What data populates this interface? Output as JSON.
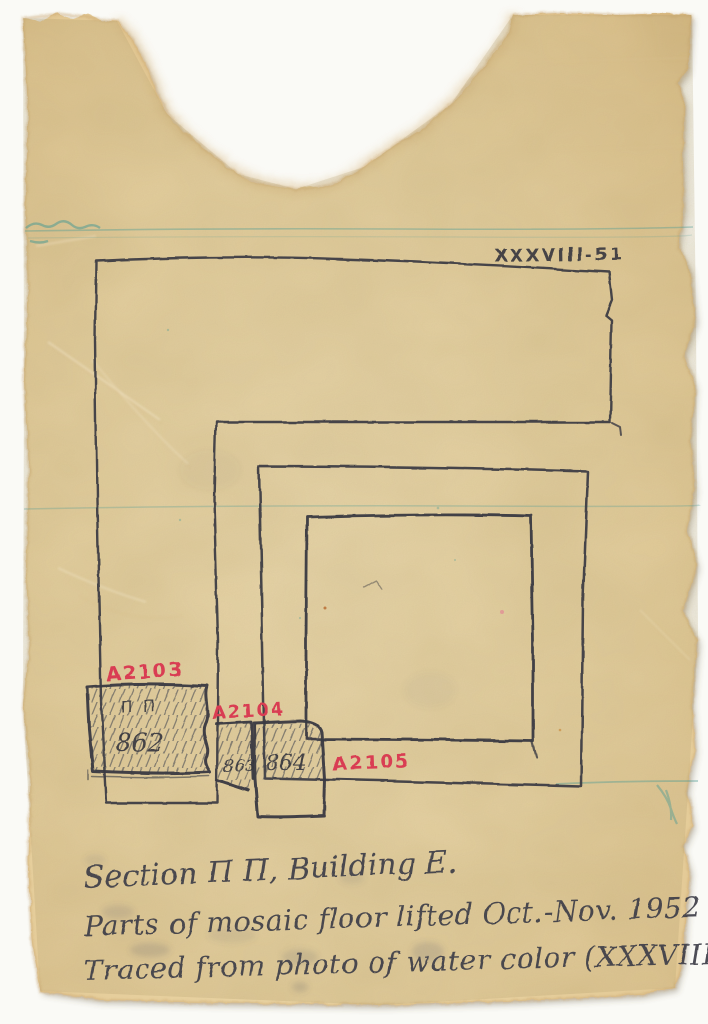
{
  "scan": {
    "background_color": "#fafaf6",
    "paper_color": "#e9d4a3"
  },
  "plate": {
    "number": "XXXVIII-51"
  },
  "finds": [
    {
      "label": "A2103",
      "section_mark": "Π Π",
      "panel_number": "862"
    },
    {
      "label": "A2104",
      "panel_number": "863"
    },
    {
      "label": "A2105",
      "panel_number": "864"
    }
  ],
  "caption": {
    "line1": "Section Π Π, Building E.",
    "line2": "Parts of mosaic floor lifted Oct.-Nov. 1952",
    "line3": "Traced from photo of water color (XXXVIII, 51)"
  },
  "ink_colors": {
    "pencil": "#393a42",
    "red": "#d93d52",
    "teal": "#4e9b94"
  }
}
